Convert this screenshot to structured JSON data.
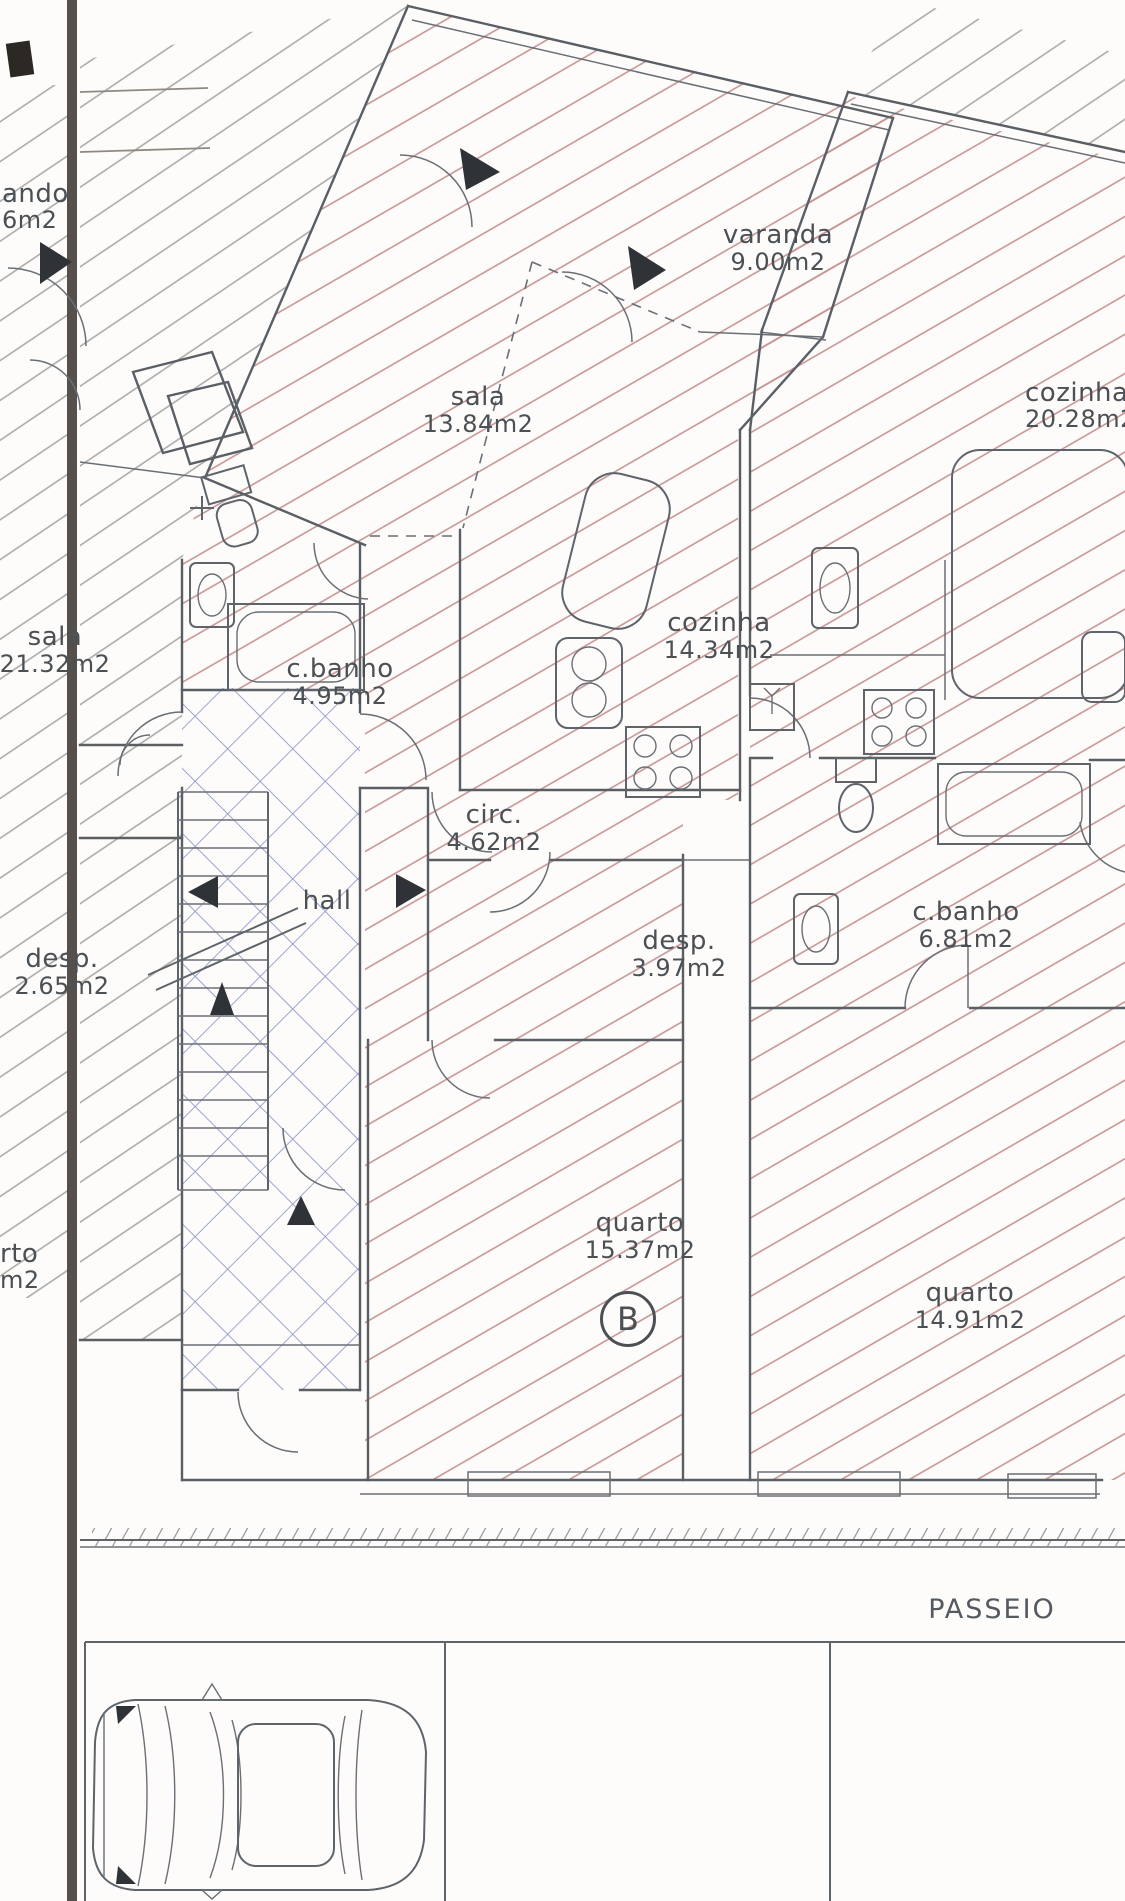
{
  "plan": {
    "unit_badge": "B",
    "labels": {
      "varanda_b": {
        "name": "varanda",
        "area": "9.00m2"
      },
      "sala_b": {
        "name": "sala",
        "area": "13.84m2"
      },
      "cozinha_b": {
        "name": "cozinha",
        "area": "14.34m2"
      },
      "cbanho_b": {
        "name": "c.banho",
        "area": "4.95m2"
      },
      "circ_b": {
        "name": "circ.",
        "area": "4.62m2"
      },
      "hall_b": {
        "name": "hall"
      },
      "desp_b": {
        "name": "desp.",
        "area": "3.97m2"
      },
      "quarto_b": {
        "name": "quarto",
        "area": "15.37m2"
      },
      "cozinha_right": {
        "name": "cozinha",
        "area": "20.28m2"
      },
      "cbanho_right": {
        "name": "c.banho",
        "area": "6.81m2"
      },
      "quarto_right": {
        "name": "quarto",
        "area": "14.91m2"
      },
      "sala_left": {
        "name": "sala",
        "area": "21.32m2"
      },
      "desp_left": {
        "name": "desp.",
        "area": "2.65m2"
      },
      "varanda_left_partial": {
        "name": "ando",
        "area": "6m2"
      },
      "quarto_left_partial": {
        "name": "rto",
        "area": "m2"
      }
    },
    "street": {
      "sidewalk": "PASSEIO"
    },
    "colors": {
      "hatch_red": "#c48f8f",
      "hatch_blue": "#8e96cc",
      "hatch_gray": "#a6a6a6",
      "wall": "#5a5f66",
      "text": "#4b5055"
    }
  }
}
